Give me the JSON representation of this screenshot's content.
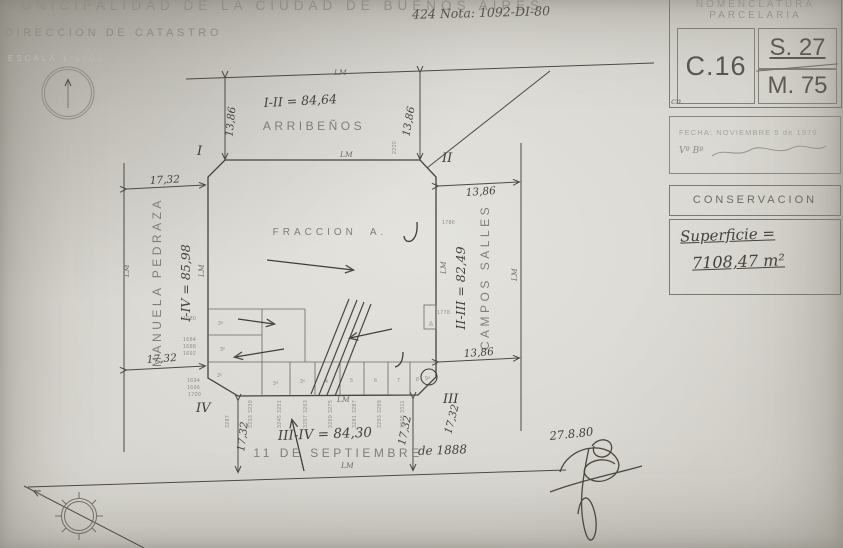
{
  "header": {
    "title": "MUNICIPALIDAD DE LA CIUDAD DE BUENOS AIRES",
    "subtitle": "DIRECCION DE CATASTRO",
    "scale": "ESCALA  1:1000",
    "note": "424 Nota: 1092-DI-80"
  },
  "panel": {
    "nomenclatura": {
      "title1": "NOMENCLATURA",
      "title2": "PARCELARIA",
      "circ": "C.16",
      "sec": "S. 27",
      "manz": "M. 75",
      "foot": "cn."
    },
    "fecha": {
      "line": "FECHA: NOVIEMBRE 5 de 1979",
      "vobo": "Vº Bº"
    },
    "conservacion": "CONSERVACION",
    "superficie": {
      "label": "Superficie =",
      "value": "7108,47 m²"
    }
  },
  "map": {
    "fraccion": "FRACCION  A.",
    "streets": {
      "top": "ARRIBEÑOS",
      "left": "MANUELA PEDRAZA",
      "right": "CAMPOS SALLES",
      "bottom": "11 DE SEPTIEMBRE",
      "bottom_year": "de 1888"
    },
    "measures": {
      "top": "I-II = 84,64",
      "left": "I-IV = 85,98",
      "right": "II-III = 82,49",
      "bottom": "III-IV = 84,30"
    },
    "widths": {
      "arribenos": "13,86",
      "pedraza": "17,32",
      "salles": "13,86",
      "septiembre": "17,32"
    },
    "corners": {
      "i": "I",
      "ii": "II",
      "iii": "III",
      "iv": "IV"
    },
    "lm": "LM",
    "lots_left": [
      "1680",
      "1684",
      "1688",
      "1692",
      "1694",
      "1696",
      "1700"
    ],
    "lots_right": [
      "1786",
      "1778"
    ],
    "parcels": {
      "p3a": "3ᵃ",
      "p3b": "3ᵇ",
      "p3c": "3ᶜ",
      "p3d": "3ᵈ",
      "p3e": "3ᵉ",
      "p4": "4",
      "p5": "5",
      "p6": "6",
      "p7": "7",
      "p8": "8",
      "p9a": "9ᵃ",
      "p9b": "9ᵇ"
    },
    "house_numbers": [
      "3233 3239",
      "3245 3251",
      "3257 3263",
      "3269 3275",
      "3281 3287",
      "3293 3299",
      "3305 3311"
    ],
    "small_numbers": {
      "top": "2220",
      "left": "3287"
    },
    "date_note": "27.8.80"
  }
}
